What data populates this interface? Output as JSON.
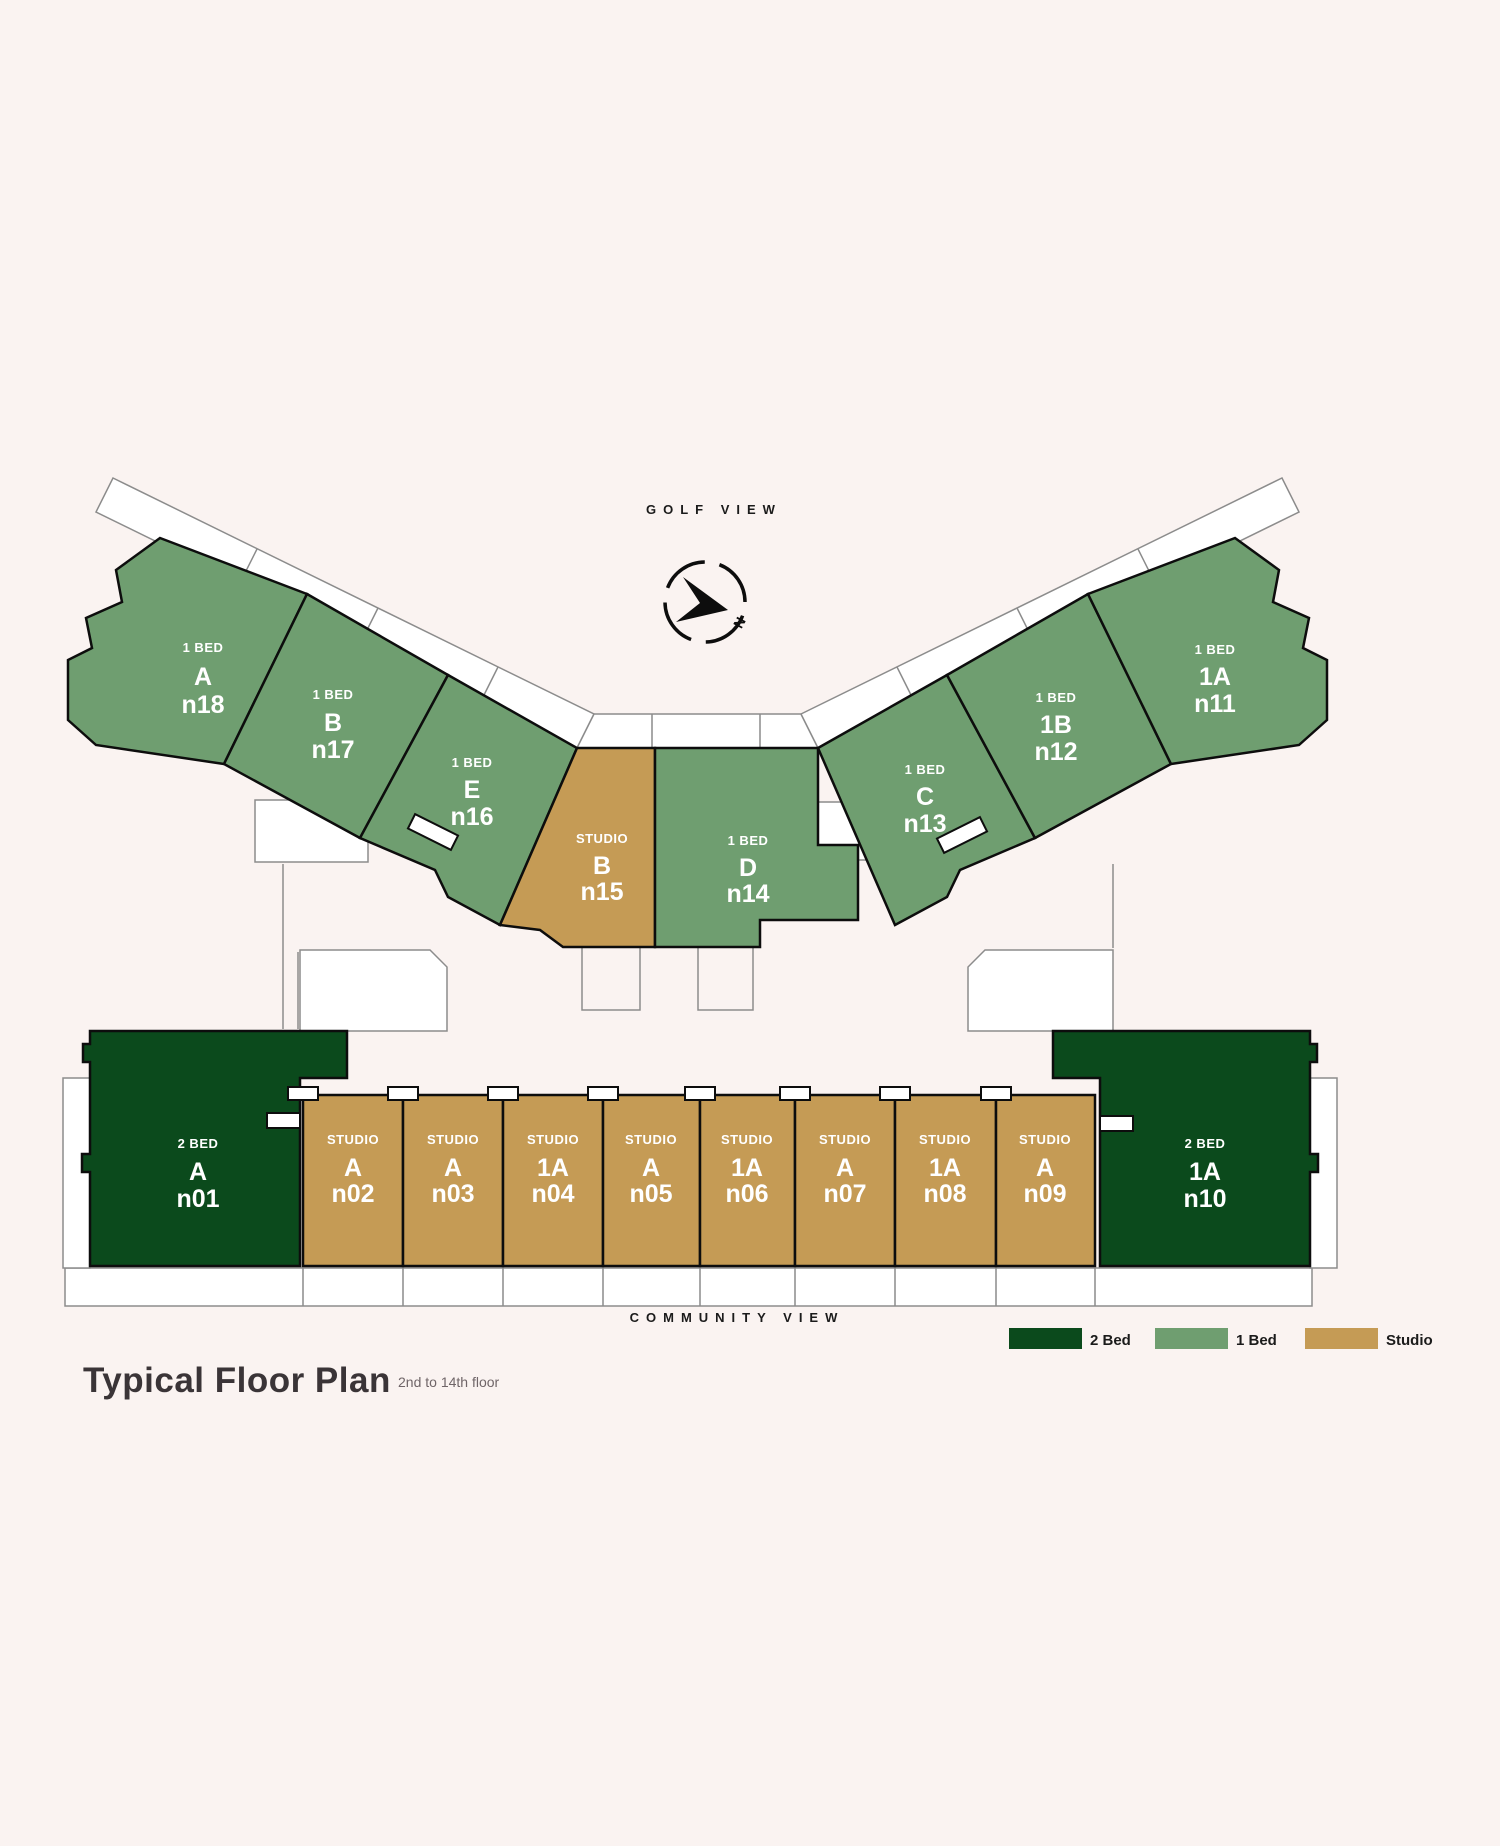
{
  "title": {
    "text": "Typical Floor Plan",
    "subtitle": "2nd to 14th floor"
  },
  "labels": {
    "golf_view": "GOLF VIEW",
    "community_view": "COMMUNITY VIEW",
    "compass_north": "N"
  },
  "colors": {
    "two_bed": "#0B4A1C",
    "one_bed": "#6F9E70",
    "studio": "#C59B55",
    "background": "#FAF3F1",
    "outline": "#0d0d0d",
    "thin_outline": "#8C8C8C",
    "label_text": "#FFFFFF"
  },
  "legend": {
    "items": [
      {
        "label": "2 Bed",
        "color": "#0B4A1C"
      },
      {
        "label": "1 Bed",
        "color": "#6F9E70"
      },
      {
        "label": "Studio",
        "color": "#C59B55"
      }
    ]
  },
  "units": [
    {
      "id": "n18",
      "type": "1 BED",
      "letter": "A",
      "number": "n18",
      "category": "one_bed"
    },
    {
      "id": "n17",
      "type": "1 BED",
      "letter": "B",
      "number": "n17",
      "category": "one_bed"
    },
    {
      "id": "n16",
      "type": "1 BED",
      "letter": "E",
      "number": "n16",
      "category": "one_bed"
    },
    {
      "id": "n15",
      "type": "STUDIO",
      "letter": "B",
      "number": "n15",
      "category": "studio"
    },
    {
      "id": "n14",
      "type": "1 BED",
      "letter": "D",
      "number": "n14",
      "category": "one_bed"
    },
    {
      "id": "n13",
      "type": "1 BED",
      "letter": "C",
      "number": "n13",
      "category": "one_bed"
    },
    {
      "id": "n12",
      "type": "1 BED",
      "letter": "1B",
      "number": "n12",
      "category": "one_bed"
    },
    {
      "id": "n11",
      "type": "1 BED",
      "letter": "1A",
      "number": "n11",
      "category": "one_bed"
    },
    {
      "id": "n01",
      "type": "2 BED",
      "letter": "A",
      "number": "n01",
      "category": "two_bed"
    },
    {
      "id": "n02",
      "type": "STUDIO",
      "letter": "A",
      "number": "n02",
      "category": "studio"
    },
    {
      "id": "n03",
      "type": "STUDIO",
      "letter": "A",
      "number": "n03",
      "category": "studio"
    },
    {
      "id": "n04",
      "type": "STUDIO",
      "letter": "1A",
      "number": "n04",
      "category": "studio"
    },
    {
      "id": "n05",
      "type": "STUDIO",
      "letter": "A",
      "number": "n05",
      "category": "studio"
    },
    {
      "id": "n06",
      "type": "STUDIO",
      "letter": "1A",
      "number": "n06",
      "category": "studio"
    },
    {
      "id": "n07",
      "type": "STUDIO",
      "letter": "A",
      "number": "n07",
      "category": "studio"
    },
    {
      "id": "n08",
      "type": "STUDIO",
      "letter": "1A",
      "number": "n08",
      "category": "studio"
    },
    {
      "id": "n09",
      "type": "STUDIO",
      "letter": "A",
      "number": "n09",
      "category": "studio"
    },
    {
      "id": "n10",
      "type": "2 BED",
      "letter": "1A",
      "number": "n10",
      "category": "two_bed"
    }
  ]
}
